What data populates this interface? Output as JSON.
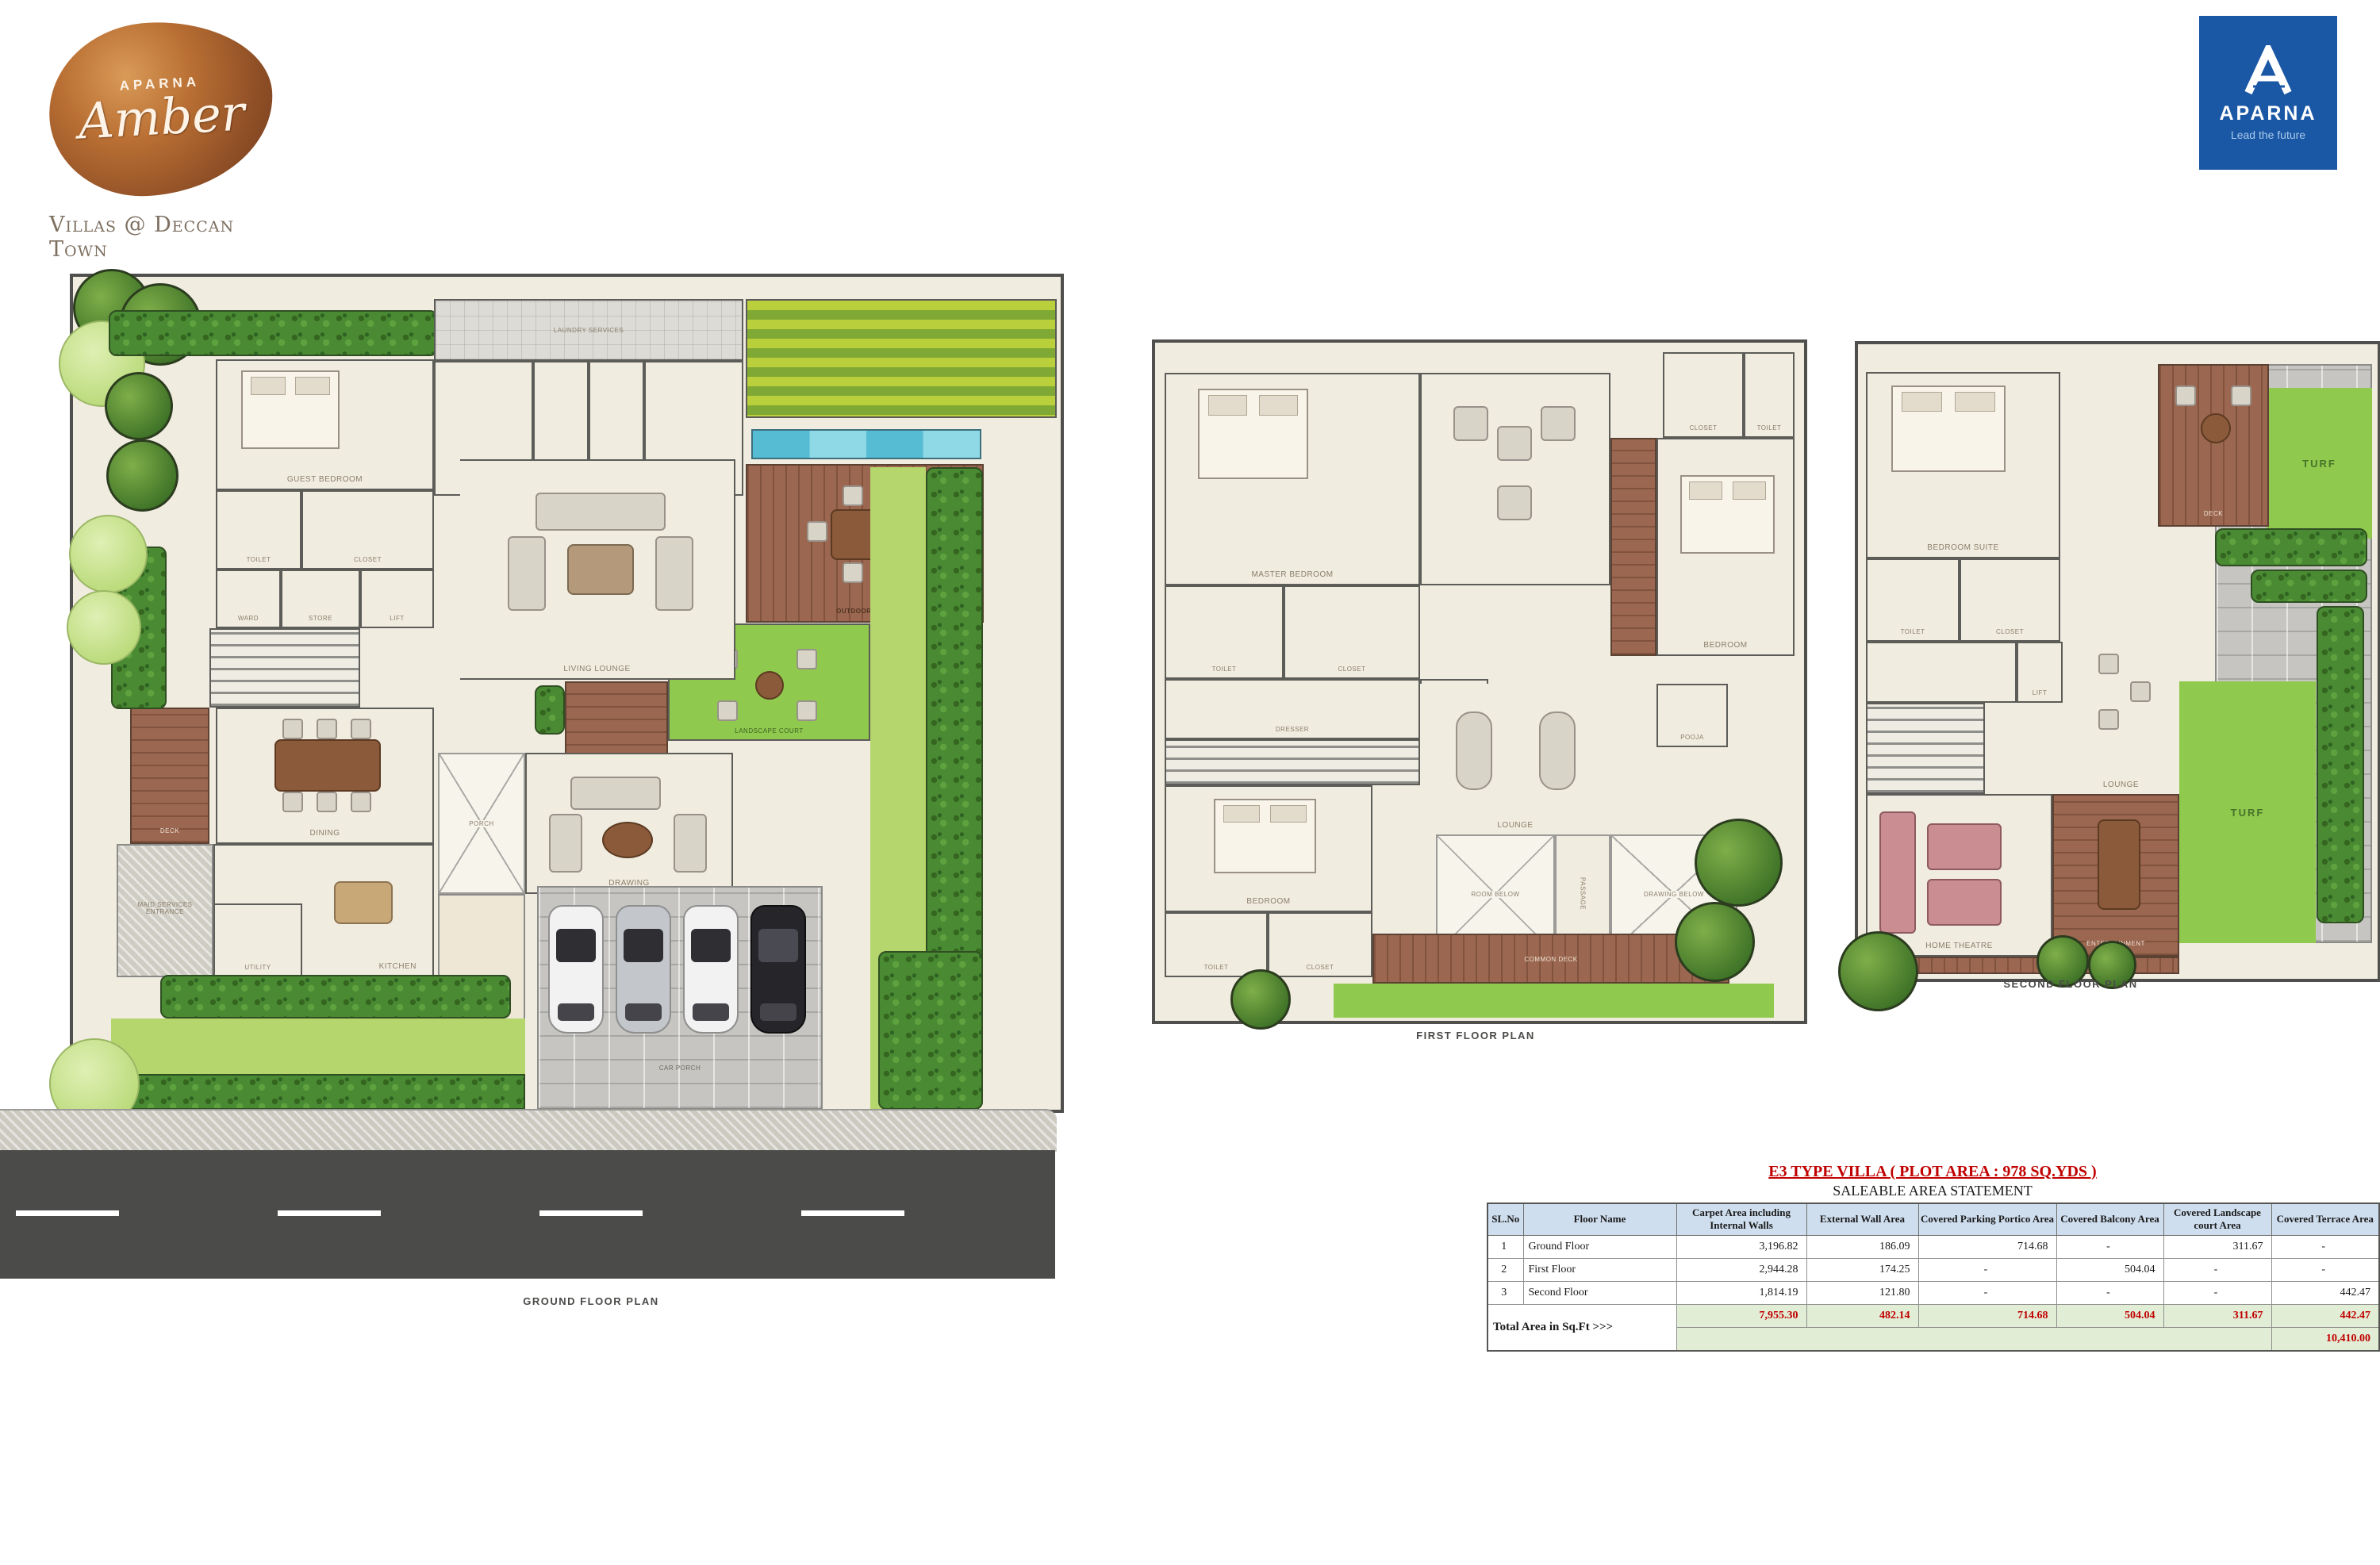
{
  "branding": {
    "amber": {
      "brand": "APARNA",
      "name": "Amber",
      "tagline": "Villas @ Deccan Town"
    },
    "aparna": {
      "name": "APARNA",
      "tagline": "Lead the future"
    }
  },
  "plans": {
    "ground": {
      "caption": "GROUND FLOOR PLAN",
      "rooms": {
        "laundry": "LAUNDRY SERVICES",
        "maid1": "MAID - 01",
        "toilet_top": "TOILET",
        "maid2": "MAID - 02",
        "pool": "POOL",
        "outdoor_deck": "OUTDOOR DECK",
        "landscape_court": "LANDSCAPE COURT",
        "guest_bedroom": "GUEST BEDROOM",
        "toilet": "TOILET",
        "closet": "CLOSET",
        "ward": "WARD",
        "store": "STORE",
        "lift": "LIFT",
        "living_lounge": "LIVING LOUNGE",
        "dining": "DINING",
        "deck": "DECK",
        "kitchen": "KITCHEN",
        "utility": "UTILITY",
        "maid_entry": "MAID SERVICES ENTRANCE",
        "porch": "PORCH",
        "drawing": "DRAWING",
        "car_porch": "CAR PORCH"
      }
    },
    "first": {
      "caption": "FIRST FLOOR PLAN",
      "rooms": {
        "master_bedroom": "MASTER BEDROOM",
        "closet_tr": "CLOSET",
        "toilet_tr": "TOILET",
        "bedroom2": "BEDROOM",
        "toilet_ml": "TOILET",
        "closet_ml": "CLOSET",
        "dresser": "DRESSER",
        "lift": "LIFT",
        "bedroom3": "BEDROOM",
        "toilet_bl": "TOILET",
        "closet_bl": "CLOSET",
        "lounge": "LOUNGE",
        "pooja": "POOJA",
        "room_below": "ROOM BELOW",
        "passage": "PASSAGE",
        "drawing_below": "DRAWING BELOW",
        "common_deck": "COMMON DECK"
      }
    },
    "second": {
      "caption": "SECOND FLOOR PLAN",
      "rooms": {
        "bedroom_suite": "BEDROOM SUITE",
        "deck": "DECK",
        "turf_top": "TURF",
        "toilet": "TOILET",
        "closet": "CLOSET",
        "lift": "LIFT",
        "lounge": "LOUNGE",
        "home_theatre": "HOME THEATRE",
        "entertainment": "ENTERTAINMENT",
        "turf_bottom": "TURF"
      }
    }
  },
  "area_table": {
    "title": "E3 TYPE VILLA  ( PLOT AREA : 978 SQ.YDS )",
    "subtitle": "SALEABLE AREA STATEMENT",
    "columns": [
      "SL.No",
      "Floor Name",
      "Carpet Area including Internal Walls",
      "External Wall Area",
      "Covered Parking Portico Area",
      "Covered Balcony Area",
      "Covered Landscape court Area",
      "Covered Terrace Area"
    ],
    "rows": [
      [
        "1",
        "Ground Floor",
        "3,196.82",
        "186.09",
        "714.68",
        "-",
        "311.67",
        "-"
      ],
      [
        "2",
        "First Floor",
        "2,944.28",
        "174.25",
        "-",
        "504.04",
        "-",
        "-"
      ],
      [
        "3",
        "Second Floor",
        "1,814.19",
        "121.80",
        "-",
        "-",
        "-",
        "442.47"
      ]
    ],
    "total_label": "Total Area in Sq.Ft >>>",
    "totals": [
      "7,955.30",
      "482.14",
      "714.68",
      "504.04",
      "311.67",
      "442.47"
    ],
    "grand_total": "10,410.00"
  }
}
